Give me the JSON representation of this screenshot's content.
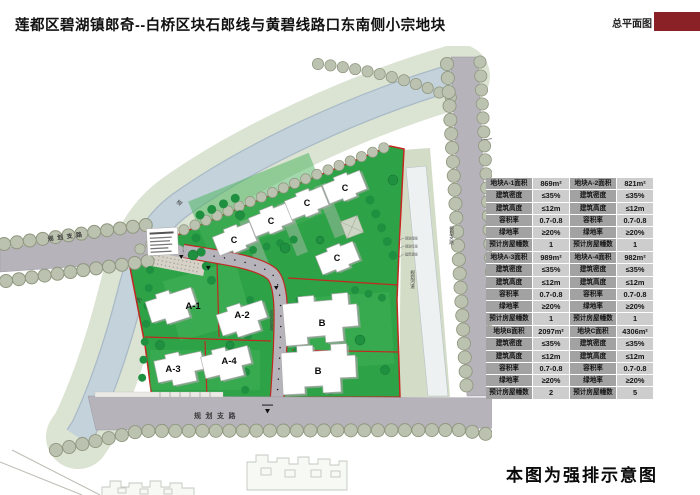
{
  "header": {
    "title": "莲都区碧湖镇郎奇--白桥区块石郎线与黄碧线路口东南侧小宗地块",
    "sheet_label": "总平面图",
    "accent_color": "#8a2127"
  },
  "map": {
    "compass": "N",
    "parcels": {
      "a1": "A-1",
      "a2": "A-2",
      "a3": "A-3",
      "a4": "A-4",
      "b": "B",
      "c": "C"
    },
    "labels": {
      "west_road": "规划支路",
      "south_road": "规划支路",
      "east_road": "规划支路",
      "channel": "规划河道",
      "internal_road": "宅间内部道路",
      "river_char_1": "道",
      "river_char_2": "河",
      "side_note_1": "规划绿线",
      "side_note_2": "规划红线",
      "side_note_3": "建筑退线"
    },
    "colors": {
      "site_green": "#2da247",
      "water": "#c3d2db",
      "bank": "#dbe3d3",
      "road": "#b6b3bb",
      "boundary_red": "#c2281f"
    }
  },
  "tables": {
    "row_labels": [
      "建筑密度",
      "建筑高度",
      "容积率",
      "绿地率",
      "预计房屋幢数"
    ],
    "plots": [
      {
        "title": "地块A-1面积",
        "area": "869m²",
        "density": "≤35%",
        "height": "≤12m",
        "plot_ratio": "0.7-0.8",
        "green_rate": "≥20%",
        "buildings": "1"
      },
      {
        "title": "地块A-2面积",
        "area": "821m²",
        "density": "≤35%",
        "height": "≤12m",
        "plot_ratio": "0.7-0.8",
        "green_rate": "≥20%",
        "buildings": "1"
      },
      {
        "title": "地块A-3面积",
        "area": "989m²",
        "density": "≤35%",
        "height": "≤12m",
        "plot_ratio": "0.7-0.8",
        "green_rate": "≥20%",
        "buildings": "1"
      },
      {
        "title": "地块A-4面积",
        "area": "982m²",
        "density": "≤35%",
        "height": "≤12m",
        "plot_ratio": "0.7-0.8",
        "green_rate": "≥20%",
        "buildings": "1"
      },
      {
        "title": "地块B面积",
        "area": "2097m²",
        "density": "≤35%",
        "height": "≤12m",
        "plot_ratio": "0.7-0.8",
        "green_rate": "≥20%",
        "buildings": "2"
      },
      {
        "title": "地块C面积",
        "area": "4306m²",
        "density": "≤35%",
        "height": "≤12m",
        "plot_ratio": "0.7-0.8",
        "green_rate": "≥20%",
        "buildings": "5"
      }
    ]
  },
  "footer": {
    "note": "本图为强排示意图"
  }
}
